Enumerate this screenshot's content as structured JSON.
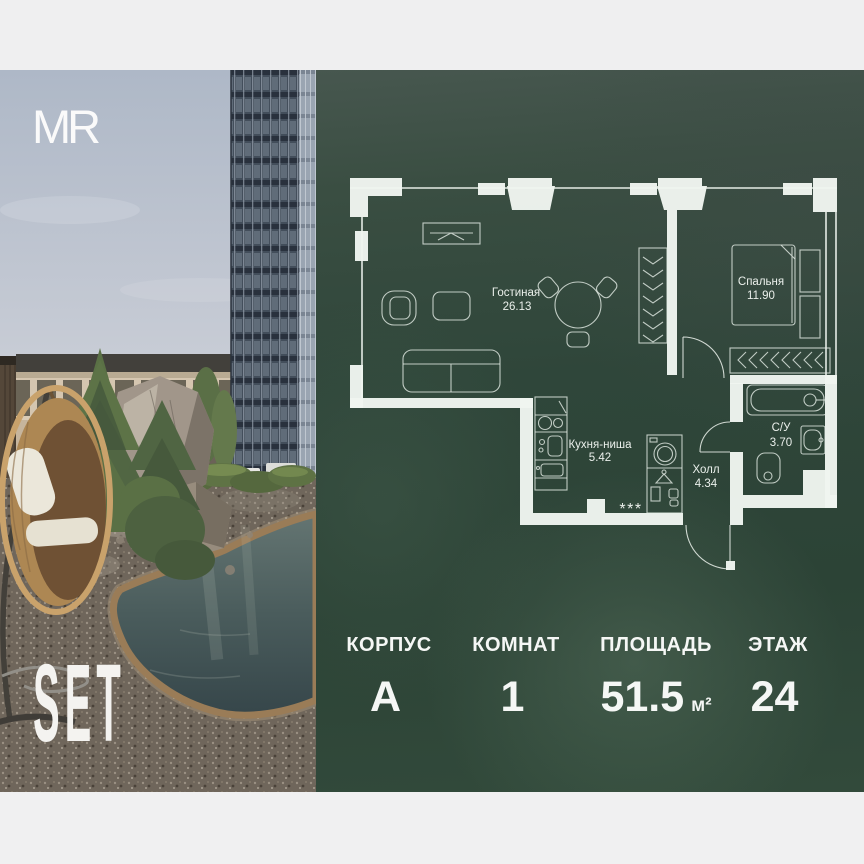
{
  "brand": {
    "developer": "MR",
    "project": "SET"
  },
  "plan": {
    "rooms": [
      {
        "name": "Гостиная",
        "area": "26.13"
      },
      {
        "name": "Спальня",
        "area": "11.90"
      },
      {
        "name": "Кухня-ниша",
        "area": "5.42"
      },
      {
        "name": "Холл",
        "area": "4.34"
      },
      {
        "name": "С/У",
        "area": "3.70"
      }
    ],
    "kitchen_marker": "***"
  },
  "info": {
    "items": [
      {
        "label": "КОРПУС",
        "value": "А",
        "unit": ""
      },
      {
        "label": "КОМНАТ",
        "value": "1",
        "unit": ""
      },
      {
        "label": "ПЛОЩАДЬ",
        "value": "51.5",
        "unit": "м²"
      },
      {
        "label": "ЭТАЖ",
        "value": "24",
        "unit": ""
      }
    ]
  },
  "colors": {
    "panel_green": "#2f463a",
    "margin_gray": "#efeff0",
    "plan_line": "#edf2ed"
  }
}
